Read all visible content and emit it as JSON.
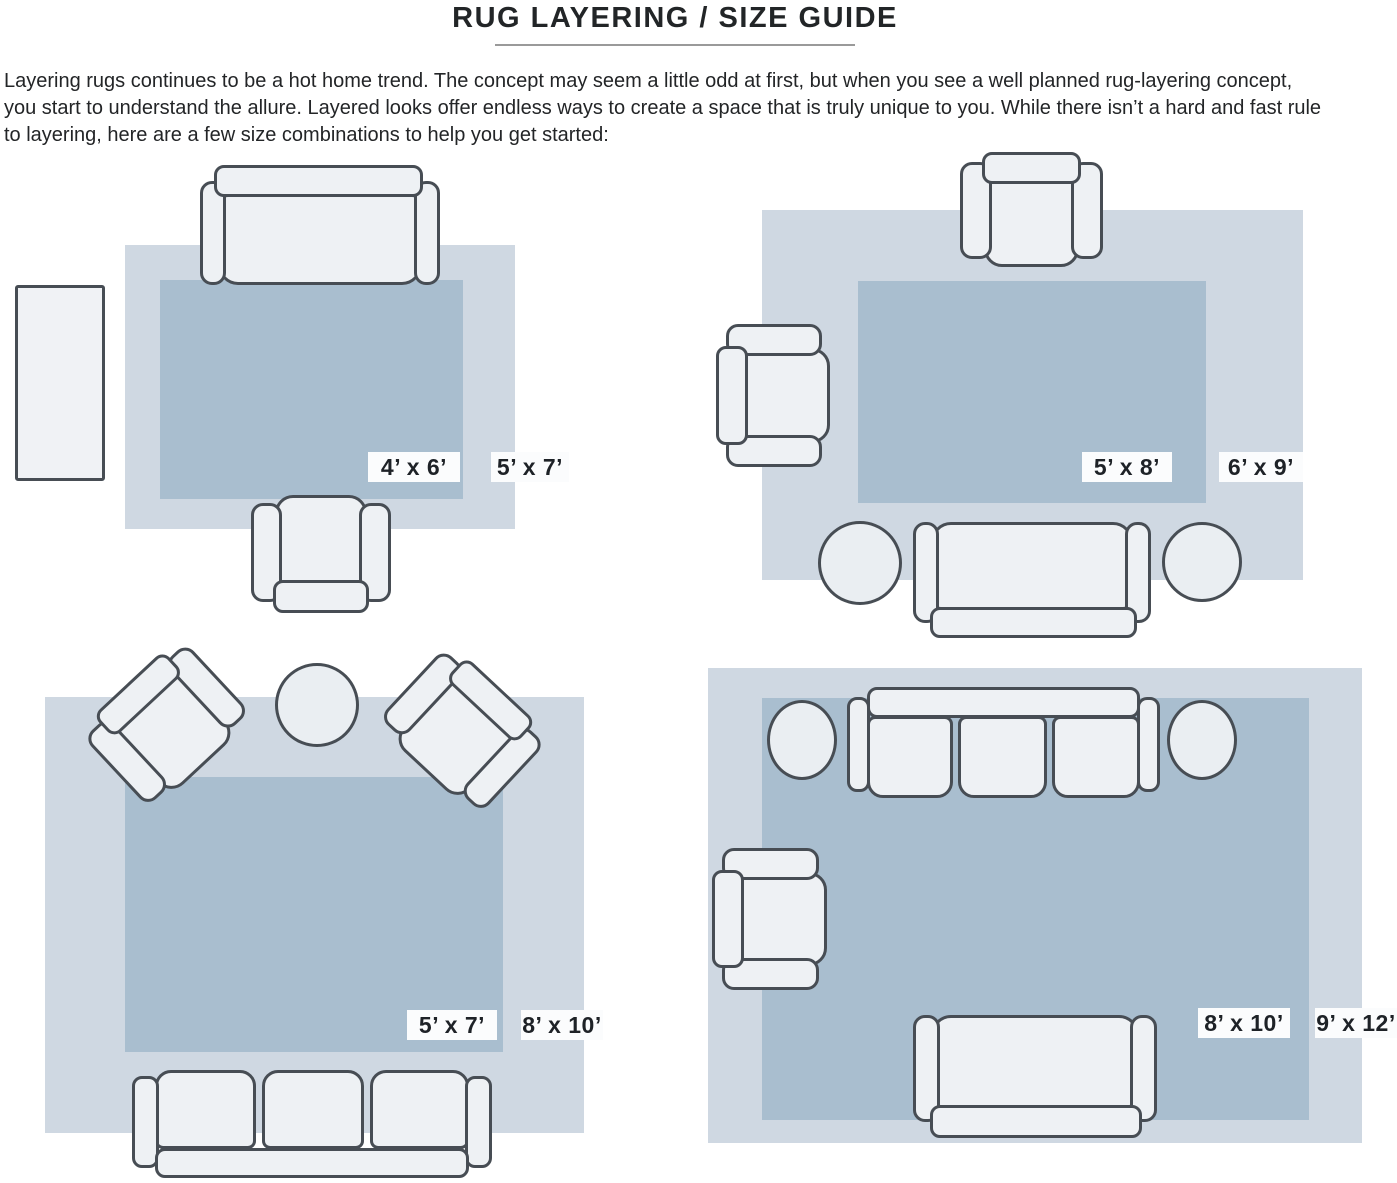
{
  "title": "RUG LAYERING / SIZE GUIDE",
  "intro": {
    "lines": [
      "Layering rugs continues to be a hot home trend. The concept may seem a little odd at first, but when you see a well planned rug-layering concept,",
      "you start to understand the allure. Layered looks offer endless ways to create a space that is truly unique to you. While there isn’t a hard and fast rule",
      "to layering, here are a few size combinations to help you get started:"
    ]
  },
  "panels": [
    {
      "inner_label": "4’ x 6’",
      "outer_label": "5’ x 7’"
    },
    {
      "inner_label": "5’ x 8’",
      "outer_label": "6’ x 9’"
    },
    {
      "inner_label": "5’ x 7’",
      "outer_label": "8’ x 10’"
    },
    {
      "inner_label": "8’ x 10’",
      "outer_label": "9’ x 12’"
    }
  ],
  "colors": {
    "outer_rug": "#cfd8e2",
    "inner_rug": "#a9becf",
    "furniture_fill": "#eef1f4",
    "furniture_stroke": "#474d54",
    "label_background": "#fbfcfd",
    "text": "#232527"
  }
}
